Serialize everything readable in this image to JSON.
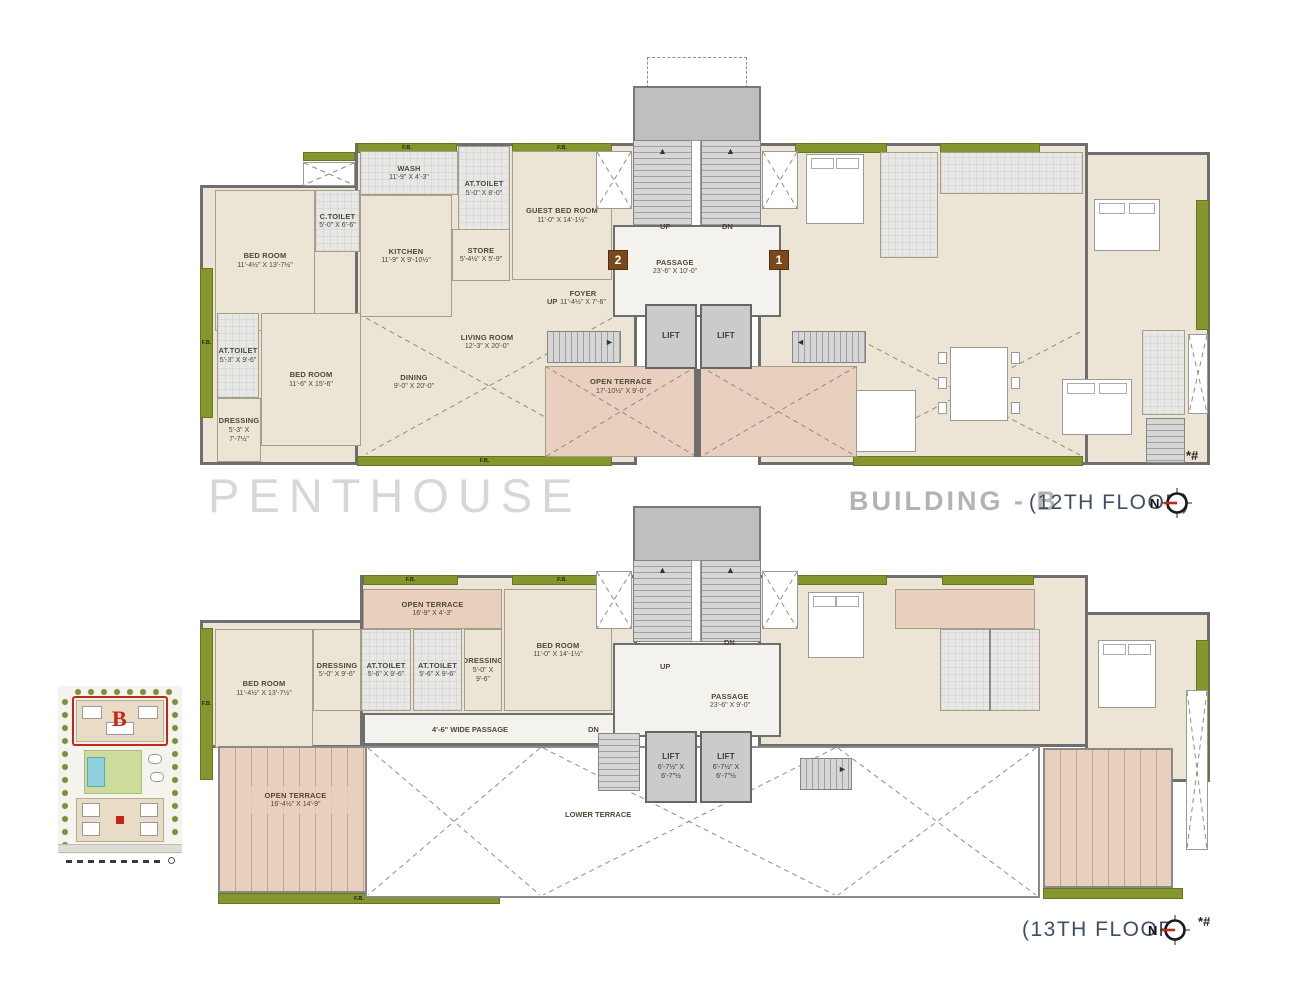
{
  "legend": {
    "penthouse": "PENTHOUSE",
    "building": "BUILDING - B",
    "floor12": "(12TH FLOOR)",
    "floor13": "(13TH FLOOR)",
    "north": "N"
  },
  "meta": {
    "footnote": "*#"
  },
  "badges": {
    "unit_1": "1",
    "unit_2": "2"
  },
  "common": {
    "fb": "F.B.",
    "up": "UP",
    "dn": "DN",
    "lift": "LIFT"
  },
  "colors": {
    "wall": "#6e6e6e",
    "floor": "#ece5d6",
    "service": "#e7e7e5",
    "terrace": "#e9cfbd",
    "flower_bed": "#85962e",
    "badge": "#7a481b",
    "title_gray": "#b3b3b3",
    "title_navy": "#3c4f66",
    "compass_needle": "#c22718"
  },
  "floor12": {
    "rooms": {
      "bed1": {
        "name": "BED ROOM",
        "dims": "11'-4½\" X 13'-7½\""
      },
      "ctoilet": {
        "name": "C.TOILET",
        "dims": "5'-0\" X 6'-6\""
      },
      "wash": {
        "name": "WASH",
        "dims": "11'-9\" X 4'-3\""
      },
      "at_top": {
        "name": "AT.TOILET",
        "dims": "5'-0\" X 8'-0\""
      },
      "kitchen": {
        "name": "KITCHEN",
        "dims": "11'-9\" X 9'-10½\""
      },
      "store": {
        "name": "STORE",
        "dims": "5'-4½\" X 5'-9\""
      },
      "guest": {
        "name": "GUEST BED ROOM",
        "dims": "11'-0\" X 14'-1½\""
      },
      "foyer": {
        "name": "FOYER",
        "dims": "11'-4½\" X 7'-6\""
      },
      "living": {
        "name": "LIVING ROOM",
        "dims": "12'-3\" X 20'-0\""
      },
      "dining": {
        "name": "DINING",
        "dims": "9'-0\" X 20'-0\""
      },
      "at2": {
        "name": "AT.TOILET",
        "dims": "5'-3\" X 9'-6\""
      },
      "bed2": {
        "name": "BED ROOM",
        "dims": "11'-6\" X 15'-6\""
      },
      "dressing": {
        "name": "DRESSING",
        "dims": "5'-3\" X 7'-7½\""
      },
      "terrace": {
        "name": "OPEN TERRACE",
        "dims": "17'-10½\" X 9'-0\""
      },
      "passage": {
        "name": "PASSAGE",
        "dims": "23'-6\" X 10'-0\""
      }
    }
  },
  "floor13": {
    "rooms": {
      "terrace_top": {
        "name": "OPEN TERRACE",
        "dims": "16'-9\" X 4'-3\""
      },
      "dressing1": {
        "name": "DRESSING",
        "dims": "5'-0\" X 9'-6\""
      },
      "at1": {
        "name": "AT.TOILET",
        "dims": "5'-6\" X 9'-6\""
      },
      "at2": {
        "name": "AT.TOILET",
        "dims": "5'-6\" X 9'-6\""
      },
      "dressing2": {
        "name": "DRESSING",
        "dims": "5'-0\" X 9'-6\""
      },
      "bed_r": {
        "name": "BED ROOM",
        "dims": "11'-0\" X 14'-1½\""
      },
      "bed_l": {
        "name": "BED ROOM",
        "dims": "11'-4½\" X 13'-7½\""
      },
      "wide_passage": {
        "name": "4'-6\" WIDE PASSAGE"
      },
      "terrace_big": {
        "name": "OPEN TERRACE",
        "dims": "16'-4½\" X 14'-9\""
      },
      "passage": {
        "name": "PASSAGE",
        "dims": "23'-6\" X 9'-0\""
      },
      "lift": {
        "name": "LIFT",
        "dims": "6'-7½\" X 6'-7\"½"
      },
      "lower": {
        "name": "LOWER TERRACE"
      }
    }
  },
  "inset": {
    "label": "B"
  }
}
